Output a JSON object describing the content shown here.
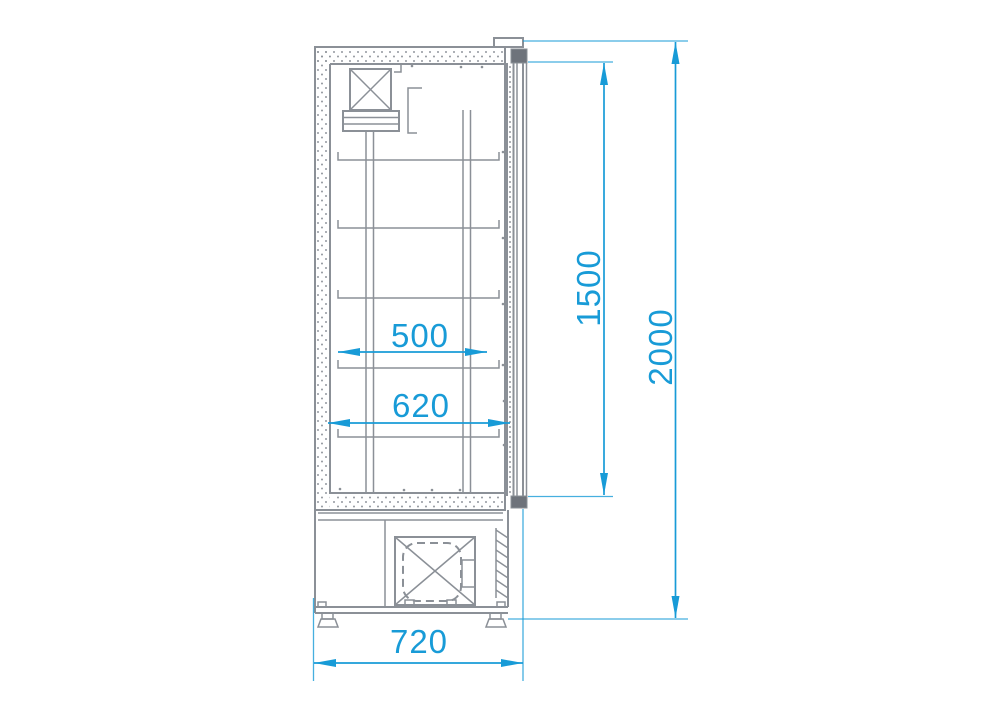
{
  "dimensions": {
    "shelf_width": {
      "label": "500",
      "orientation": "horizontal"
    },
    "interior_depth": {
      "label": "620",
      "orientation": "horizontal"
    },
    "door_height": {
      "label": "1500",
      "orientation": "vertical"
    },
    "overall_height": {
      "label": "2000",
      "orientation": "vertical"
    },
    "overall_depth": {
      "label": "720",
      "orientation": "horizontal"
    }
  },
  "colors": {
    "background": "#ffffff",
    "line_gray": "#8b9097",
    "hinge_dark_gray": "#6e737b",
    "dimension_blue": "#189bd7"
  }
}
